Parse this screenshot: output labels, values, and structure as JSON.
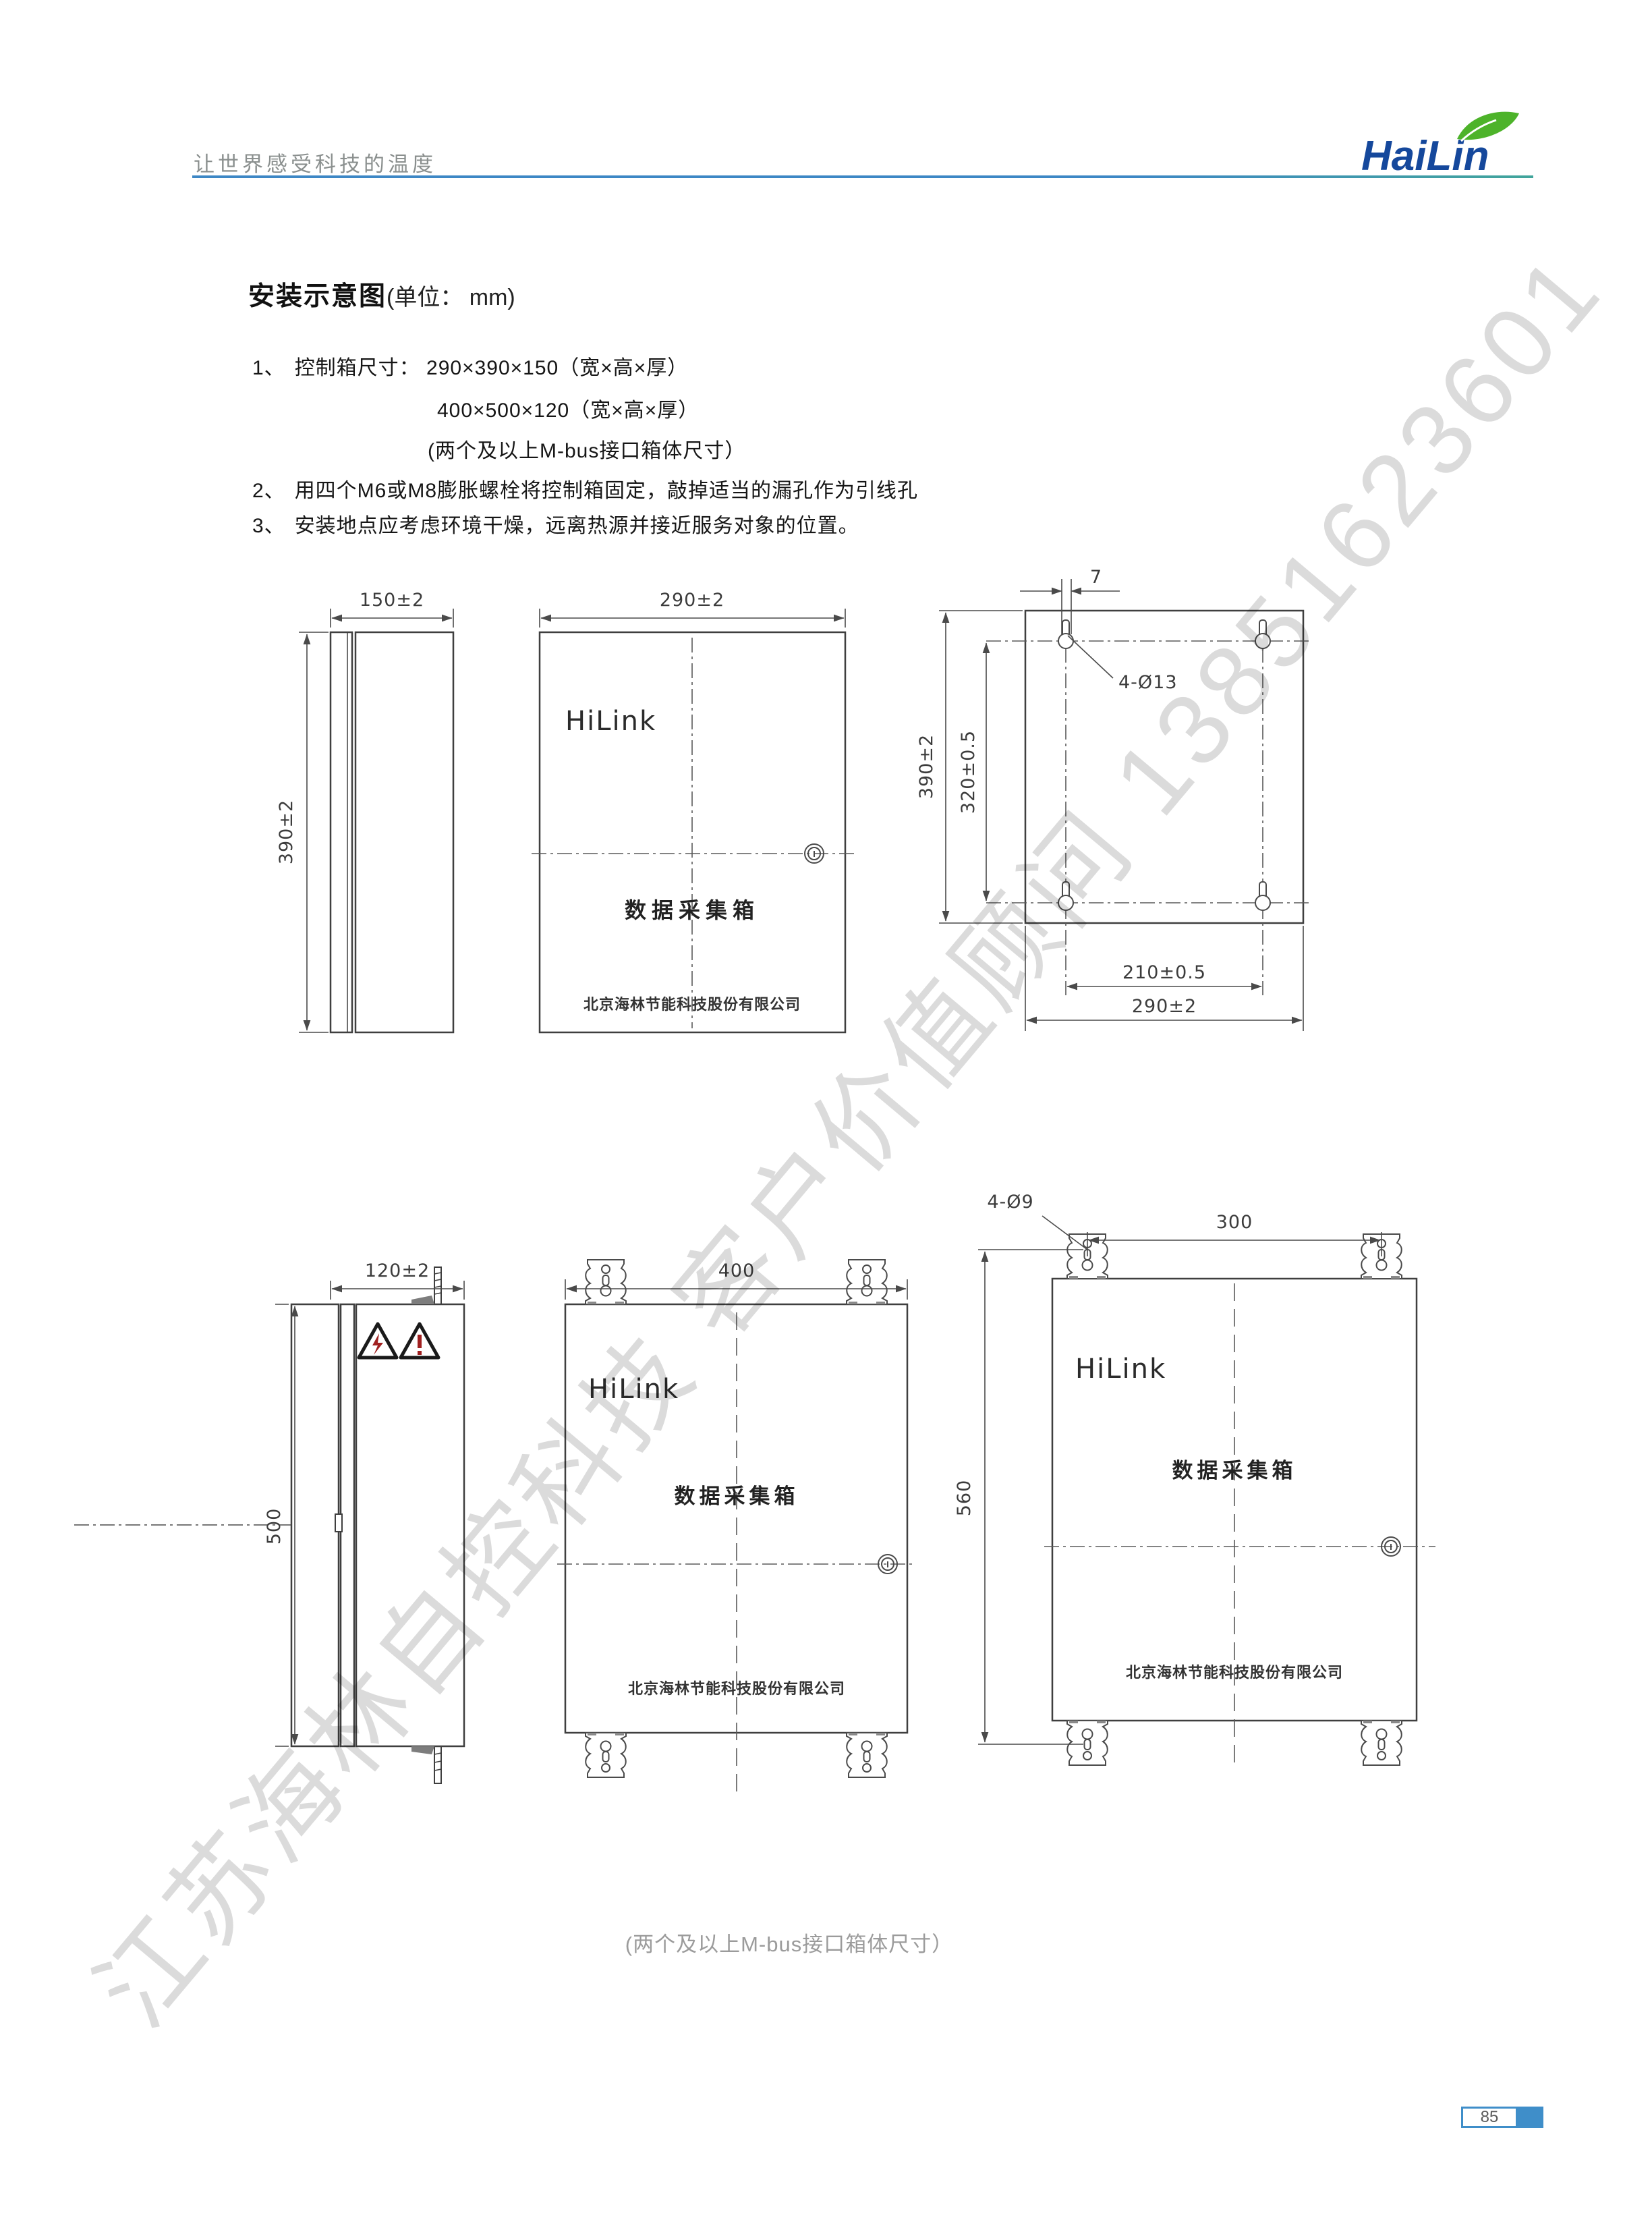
{
  "header": {
    "slogan": "让世界感受科技的温度",
    "logo_text": "HaiLin"
  },
  "title": {
    "main": "安装示意图",
    "unit": "(单位： mm)"
  },
  "notes": {
    "item1_num": "1、",
    "item1_text": "控制箱尺寸： 290×390×150（宽×高×厚）",
    "item1_dim2": "400×500×120（宽×高×厚）",
    "item1_note": "(两个及以上M-bus接口箱体尺寸）",
    "item2_num": "2、",
    "item2_text": "用四个M6或M8膨胀螺栓将控制箱固定，敲掉适当的漏孔作为引线孔",
    "item3_num": "3、",
    "item3_text": "安装地点应考虑环境干燥，远离热源并接近服务对象的位置。"
  },
  "drawings": {
    "brand": "HiLink",
    "box_label": "数据采集箱",
    "company": "北京海林节能科技股份有限公司",
    "small": {
      "depth": "150±2",
      "height": "390±2",
      "width": "290±2",
      "back_height": "390±2",
      "back_hole_v": "320±0.5",
      "back_hole_h": "210±0.5",
      "back_width": "290±2",
      "slot": "7",
      "holes": "4-Ø13"
    },
    "large": {
      "depth": "120±2",
      "height": "500",
      "width": "400",
      "holes": "4-Ø9",
      "hole_span": "300",
      "back_height": "560"
    },
    "caption": "(两个及以上M-bus接口箱体尺寸）"
  },
  "watermark": "江苏海林自控科技 客户价值顾问 13851623601",
  "footer": {
    "page_number": "85"
  }
}
